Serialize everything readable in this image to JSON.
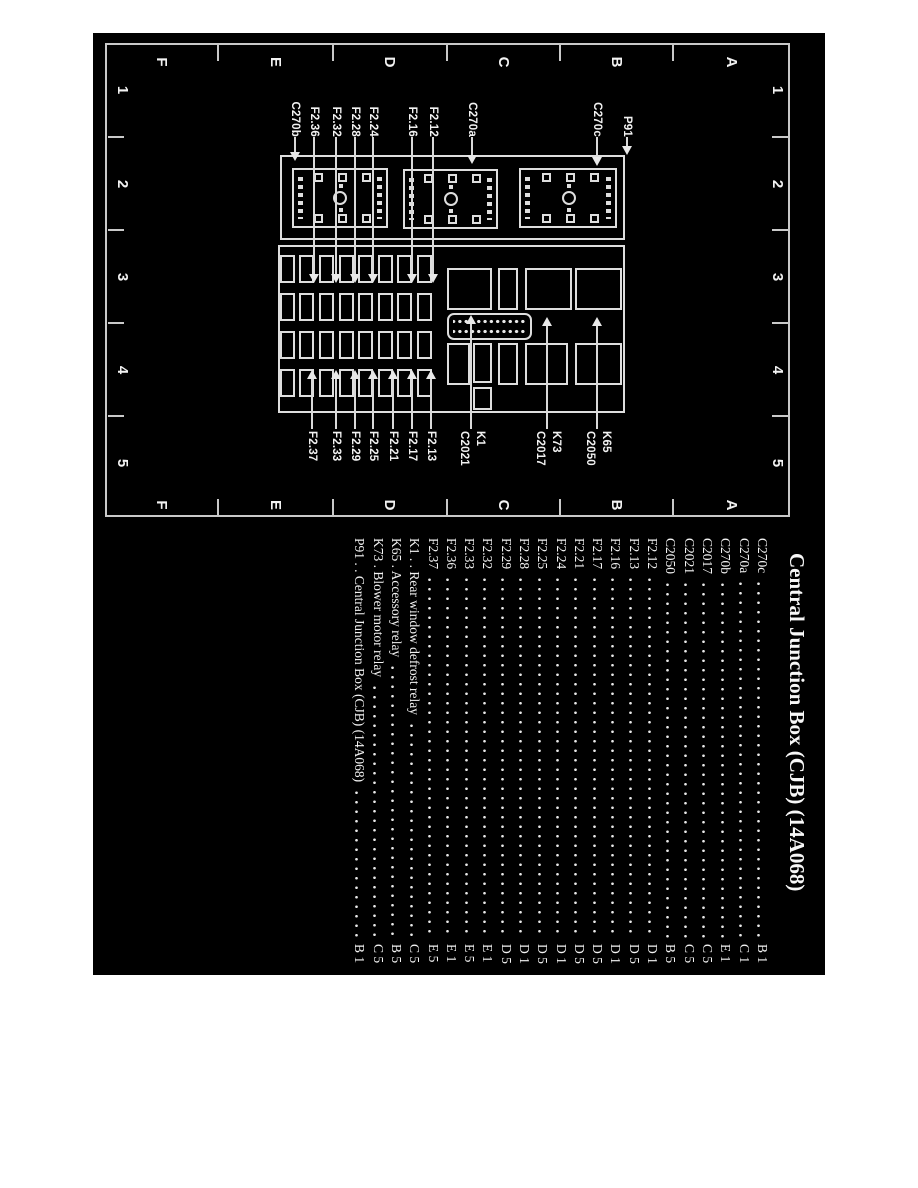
{
  "title": "Central Junction Box (CJB) (14A068)",
  "grid": {
    "letters": [
      "A",
      "B",
      "C",
      "D",
      "E",
      "F"
    ],
    "numbers": [
      "1",
      "2",
      "3",
      "4",
      "5"
    ]
  },
  "diagram": {
    "left_labels": [
      "P91",
      "C270c",
      "C270a",
      "F2.12",
      "F2.16",
      "F2.24",
      "F2.28",
      "F2.32",
      "F2.36",
      "C270b"
    ],
    "relay_labels": [
      {
        "line1": "K65",
        "line2": "C2050"
      },
      {
        "line1": "K73",
        "line2": "C2017"
      },
      {
        "line1": "K1",
        "line2": "C2021"
      }
    ],
    "right_fuse_labels": [
      "F2.13",
      "F2.17",
      "F2.21",
      "F2.25",
      "F2.29",
      "F2.33",
      "F2.37"
    ]
  },
  "legend": {
    "rows": [
      {
        "left": "C270c",
        "ref": "B 1"
      },
      {
        "left": "C270a",
        "ref": "C 1"
      },
      {
        "left": "C270b",
        "ref": "E 1"
      },
      {
        "left": "C2017",
        "ref": "C 5"
      },
      {
        "left": "C2021",
        "ref": "C 5"
      },
      {
        "left": "C2050",
        "ref": "B 5"
      },
      {
        "left": "F2.12",
        "ref": "D 1"
      },
      {
        "left": "F2.13",
        "ref": "D 5"
      },
      {
        "left": "F2.16",
        "ref": "D 1"
      },
      {
        "left": "F2.17",
        "ref": "D 5"
      },
      {
        "left": "F2.21",
        "ref": "D 5"
      },
      {
        "left": "F2.24",
        "ref": "D 1"
      },
      {
        "left": "F2.25",
        "ref": "D 5"
      },
      {
        "left": "F2.28",
        "ref": "D 1"
      },
      {
        "left": "F2.29",
        "ref": "D 5"
      },
      {
        "left": "F2.32",
        "ref": "E 1"
      },
      {
        "left": "F2.33",
        "ref": "E 5"
      },
      {
        "left": "F2.36",
        "ref": "E 1"
      },
      {
        "left": "F2.37",
        "ref": "E 5"
      },
      {
        "left": "K1 . . Rear window defrost relay",
        "ref": "C 5"
      },
      {
        "left": "K65 . Accessory relay",
        "ref": "B 5"
      },
      {
        "left": "K73 . Blower motor relay",
        "ref": "C 5"
      },
      {
        "left": "P91 . . Central Junction Box (CJB) (14A068)",
        "ref": "B 1"
      }
    ]
  },
  "colors": {
    "page_bg": "#ffffff",
    "figure_bg": "#000000",
    "ink": "#f2f2f2",
    "line": "#d9d9d9"
  }
}
